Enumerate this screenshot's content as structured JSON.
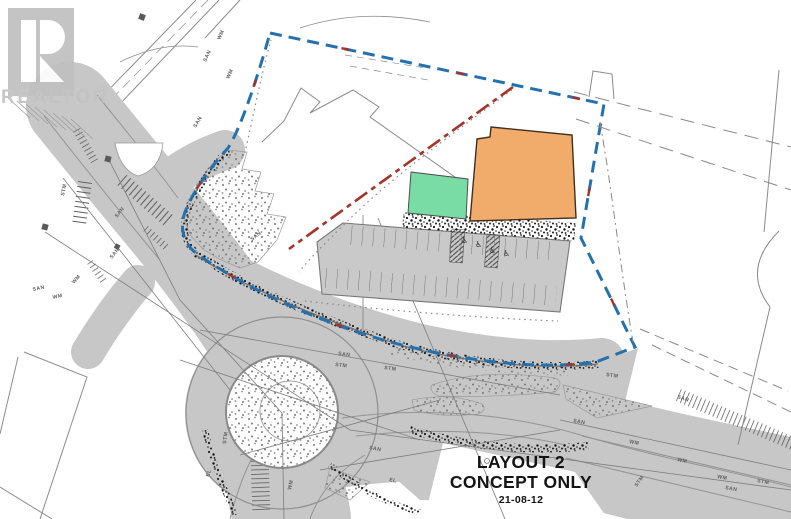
{
  "image_type": "real-estate site plan concept drawing",
  "watermark": {
    "logo_letter": "R",
    "brand": "REALTOR",
    "registered_mark": "®"
  },
  "title_block": {
    "layout_label": "LAYOUT 2",
    "concept_label": "CONCEPT ONLY",
    "date": "21-08-12"
  },
  "colors": {
    "proposed_building_orange": "#f1ab6b",
    "amenity_building_green": "#79dca4",
    "site_boundary_blue": "#2471ae",
    "property_line_red": "#a5332a",
    "road_fill": "#c7c7c7",
    "watermark_gray": "#c3c3c3",
    "background": "#ffffff"
  },
  "utility_annotations": [
    {
      "text": "SAN",
      "x": 206,
      "y": 62,
      "rot": -65
    },
    {
      "text": "WM",
      "x": 220,
      "y": 40,
      "rot": -65
    },
    {
      "text": "WM",
      "x": 229,
      "y": 79,
      "rot": -65
    },
    {
      "text": "SAN",
      "x": 196,
      "y": 128,
      "rot": -60
    },
    {
      "text": "STM",
      "x": 64,
      "y": 196,
      "rot": -78
    },
    {
      "text": "SAN",
      "x": 117,
      "y": 218,
      "rot": -52
    },
    {
      "text": "SAN",
      "x": 112,
      "y": 259,
      "rot": -52
    },
    {
      "text": "WM",
      "x": 74,
      "y": 284,
      "rot": -48
    },
    {
      "text": "SAN",
      "x": 33,
      "y": 291,
      "rot": -12
    },
    {
      "text": "WM",
      "x": 53,
      "y": 299,
      "rot": -12
    },
    {
      "text": "SAN",
      "x": 252,
      "y": 241,
      "rot": -38
    },
    {
      "text": "SAN",
      "x": 338,
      "y": 355,
      "rot": 7
    },
    {
      "text": "STM",
      "x": 335,
      "y": 366,
      "rot": 7
    },
    {
      "text": "STM",
      "x": 384,
      "y": 369,
      "rot": 9
    },
    {
      "text": "STM",
      "x": 226,
      "y": 444,
      "rot": -82
    },
    {
      "text": "SAN",
      "x": 369,
      "y": 449,
      "rot": 11
    },
    {
      "text": "WM",
      "x": 291,
      "y": 490,
      "rot": -78
    },
    {
      "text": "EL",
      "x": 209,
      "y": 477,
      "rot": -72
    },
    {
      "text": "EL",
      "x": 389,
      "y": 481,
      "rot": 13
    },
    {
      "text": "SAN",
      "x": 573,
      "y": 422,
      "rot": 11
    },
    {
      "text": "WM",
      "x": 629,
      "y": 443,
      "rot": 11
    },
    {
      "text": "WM",
      "x": 677,
      "y": 461,
      "rot": 11
    },
    {
      "text": "WM",
      "x": 717,
      "y": 478,
      "rot": 11
    },
    {
      "text": "SAN",
      "x": 725,
      "y": 489,
      "rot": 11
    },
    {
      "text": "STM",
      "x": 637,
      "y": 487,
      "rot": -55
    },
    {
      "text": "STM",
      "x": 757,
      "y": 482,
      "rot": 11
    },
    {
      "text": "SAN",
      "x": 677,
      "y": 398,
      "rot": 18
    },
    {
      "text": "STM",
      "x": 606,
      "y": 376,
      "rot": 9
    }
  ]
}
